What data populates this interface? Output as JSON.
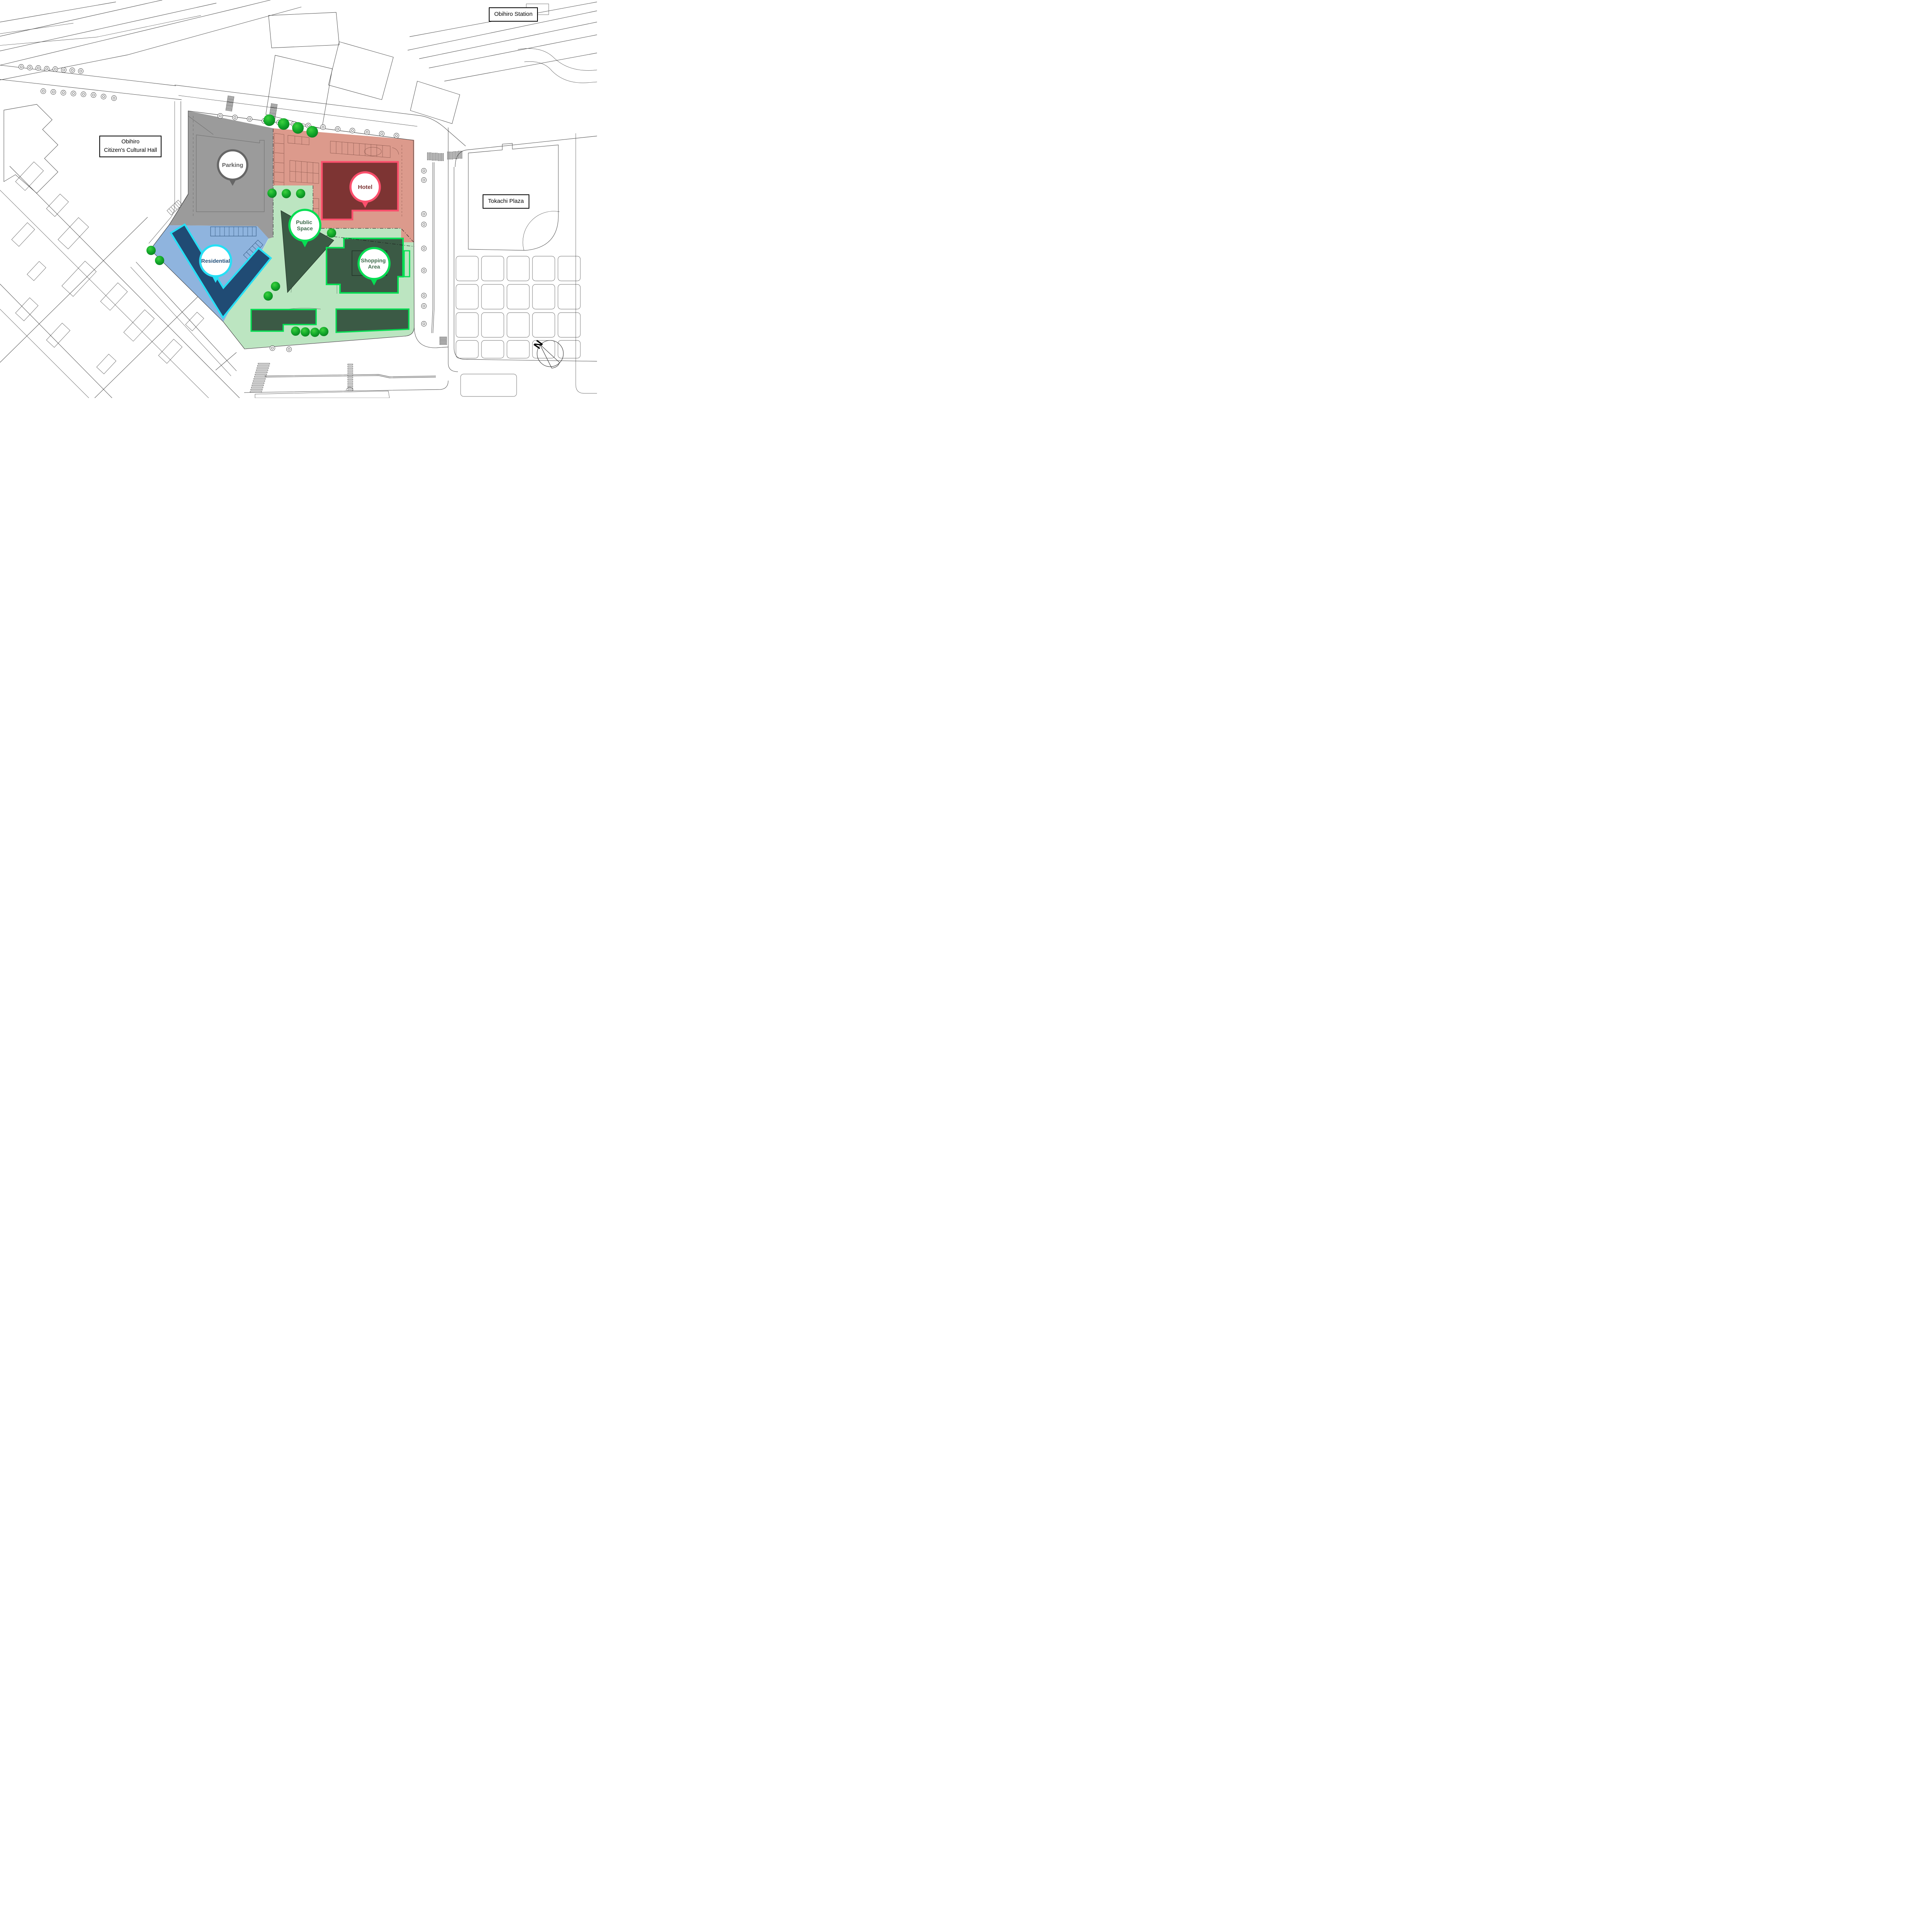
{
  "labels": {
    "station": "Obihiro Station",
    "cultural_hall_line1": "Obihiro",
    "cultural_hall_line2": "Citizen's Cultural Hall",
    "tokachi_plaza": "Tokachi Plaza"
  },
  "balloons": {
    "parking": {
      "label": "Parking"
    },
    "hotel": {
      "label": "Hotel"
    },
    "public_space": {
      "line1": "Public",
      "line2": "Space"
    },
    "residential": {
      "label": "Residential"
    },
    "shopping": {
      "line1": "Shopping",
      "line2": "Area"
    }
  },
  "compass": {
    "north_label": "N"
  },
  "colors": {
    "ink": "#3b3b3b",
    "zone-gray": "#9B9B9B",
    "gray-accent": "#666666",
    "gray-text": "#5F5F5F",
    "zone-salmon": "#DC9A8C",
    "hotel-fill": "#7D3433",
    "hotel-border": "#FB4F6C",
    "maroon-text": "#7D3433",
    "zone-green": "#BCE5C1",
    "green-building": "#3B5A45",
    "green-border": "#06DE53",
    "green-text": "#3D6A4B",
    "zone-blue": "#8FB4DE",
    "blue-building": "#204B74",
    "blue-border": "#27DFF5",
    "blue-text": "#1F4E79",
    "tree-light": "#3ED13F",
    "tree-mid": "#12A82A",
    "tree-dark": "#0B7F20"
  }
}
